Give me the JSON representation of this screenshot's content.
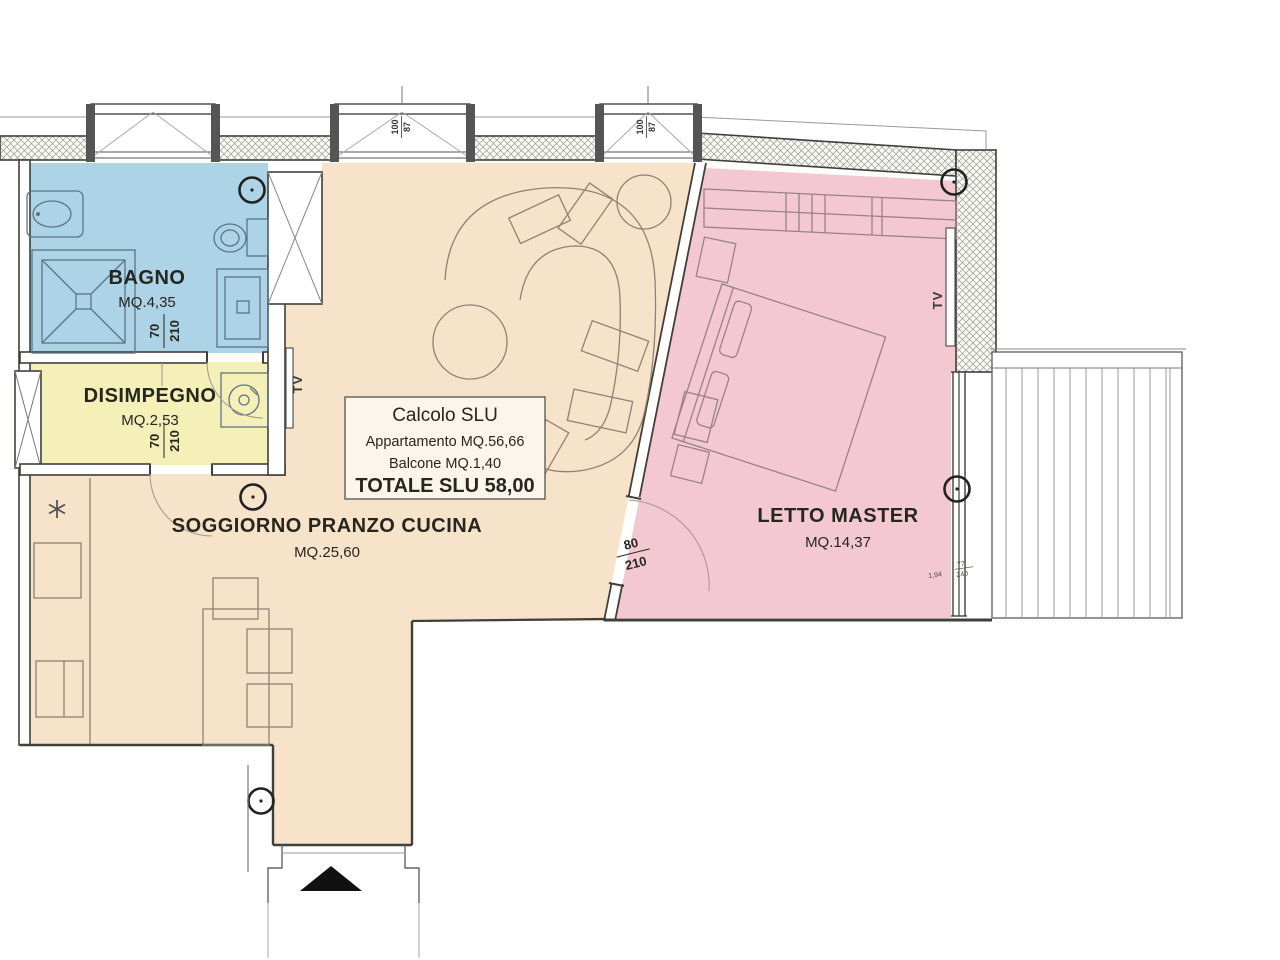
{
  "plan": {
    "rooms": {
      "bagno": {
        "label": "BAGNO",
        "area": "MQ.4,35",
        "fill": "#acd3e6"
      },
      "disimpegno": {
        "label": "DISIMPEGNO",
        "area": "MQ.2,53",
        "fill": "#f4f0b8"
      },
      "soggiorno": {
        "label": "SOGGIORNO PRANZO CUCINA",
        "area": "MQ.25,60",
        "fill": "#f6e3ca"
      },
      "letto_master": {
        "label": "LETTO MASTER",
        "area": "MQ.14,37",
        "fill": "#f3c8d2"
      }
    },
    "slu_box": {
      "title": "Calcolo SLU",
      "apartment": "Appartamento MQ.56,66",
      "balcony": "Balcone MQ.1,40",
      "total": "TOTALE SLU 58,00"
    },
    "doors": {
      "bagno": {
        "width": "70",
        "height": "210"
      },
      "disimpegno": {
        "width": "70",
        "height": "210"
      },
      "letto_master": {
        "width": "80",
        "height": "210"
      }
    },
    "windows": {
      "soggiorno_left": {
        "width": "100",
        "height": "87"
      },
      "soggiorno_right": {
        "width": "100",
        "height": "87"
      },
      "letto_master": {
        "length": "1,94",
        "width": "77",
        "height": "240"
      }
    },
    "tv_labels": {
      "soggiorno": "TV",
      "letto": "TV"
    }
  }
}
